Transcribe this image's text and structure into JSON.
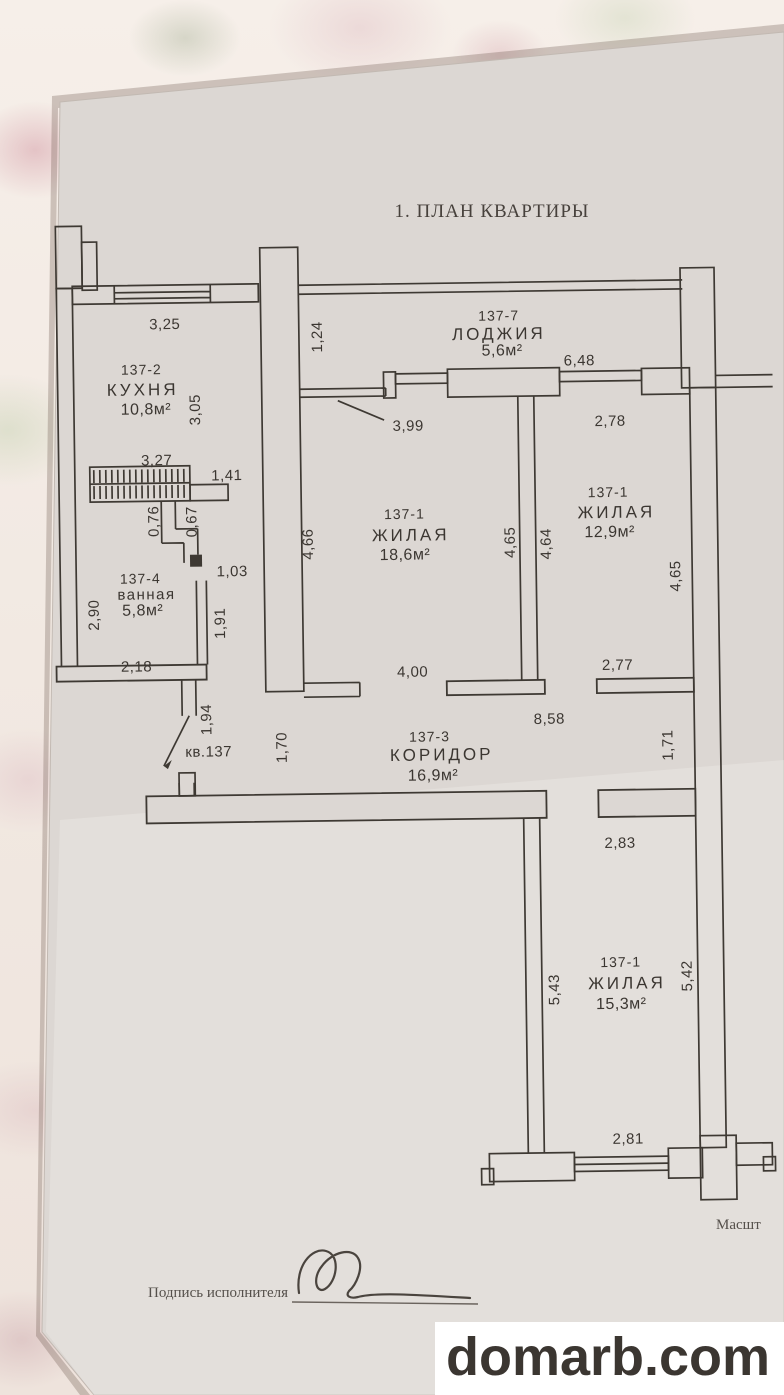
{
  "document": {
    "title": "1. ПЛАН КВАРТИРЫ",
    "scale_label_partial": "Масшт",
    "signature_label": "Подпись исполнителя",
    "apartment_number_label": "кв.137"
  },
  "watermark": {
    "text": "domarb.com",
    "color": "#8e1212",
    "background": "#ffffff"
  },
  "colors": {
    "ink": "#3e3933",
    "paper": "#dcd7d3"
  },
  "rooms": {
    "kitchen": {
      "number": "137-2",
      "name": "КУХНЯ",
      "area": "10,8м²"
    },
    "loggia": {
      "number": "137-7",
      "name": "ЛОДЖИЯ",
      "area": "5,6м²"
    },
    "living_center": {
      "number": "137-1",
      "name": "ЖИЛАЯ",
      "area": "18,6м²"
    },
    "living_right": {
      "number": "137-1",
      "name": "ЖИЛАЯ",
      "area": "12,9м²"
    },
    "bathroom": {
      "number": "137-4",
      "name": "ванная",
      "area": "5,8м²"
    },
    "corridor": {
      "number": "137-3",
      "name": "КОРИДОР",
      "area": "16,9м²"
    },
    "living_bottom": {
      "number": "137-1",
      "name": "ЖИЛАЯ",
      "area": "15,3м²"
    }
  },
  "dimensions": {
    "kitchen_top": "3,25",
    "kitchen_depth": "3,05",
    "wall_gap": "1,24",
    "vent_top": "3,27",
    "vent_right": "1,41",
    "flue_left": "0,76",
    "flue_right": "0,67",
    "shaft_offset": "1,03",
    "bathroom_left": "2,90",
    "bathroom_right": "1,91",
    "bathroom_bottom": "2,18",
    "entry_wall": "1,94",
    "corridor_left": "1,70",
    "living_center_door": "3,99",
    "living_center_left": "4,66",
    "living_center_right": "4,65",
    "divider_right": "4,64",
    "living_center_bottom": "4,00",
    "corridor_length": "8,58",
    "loggia_width": "6,48",
    "living_right_top": "2,78",
    "living_right_side": "4,65",
    "living_right_bottom": "2,77",
    "corridor_right": "1,71",
    "bottom_room_top": "2,83",
    "bottom_room_left": "5,43",
    "bottom_room_right": "5,42",
    "bottom_room_bottom": "2,81"
  }
}
